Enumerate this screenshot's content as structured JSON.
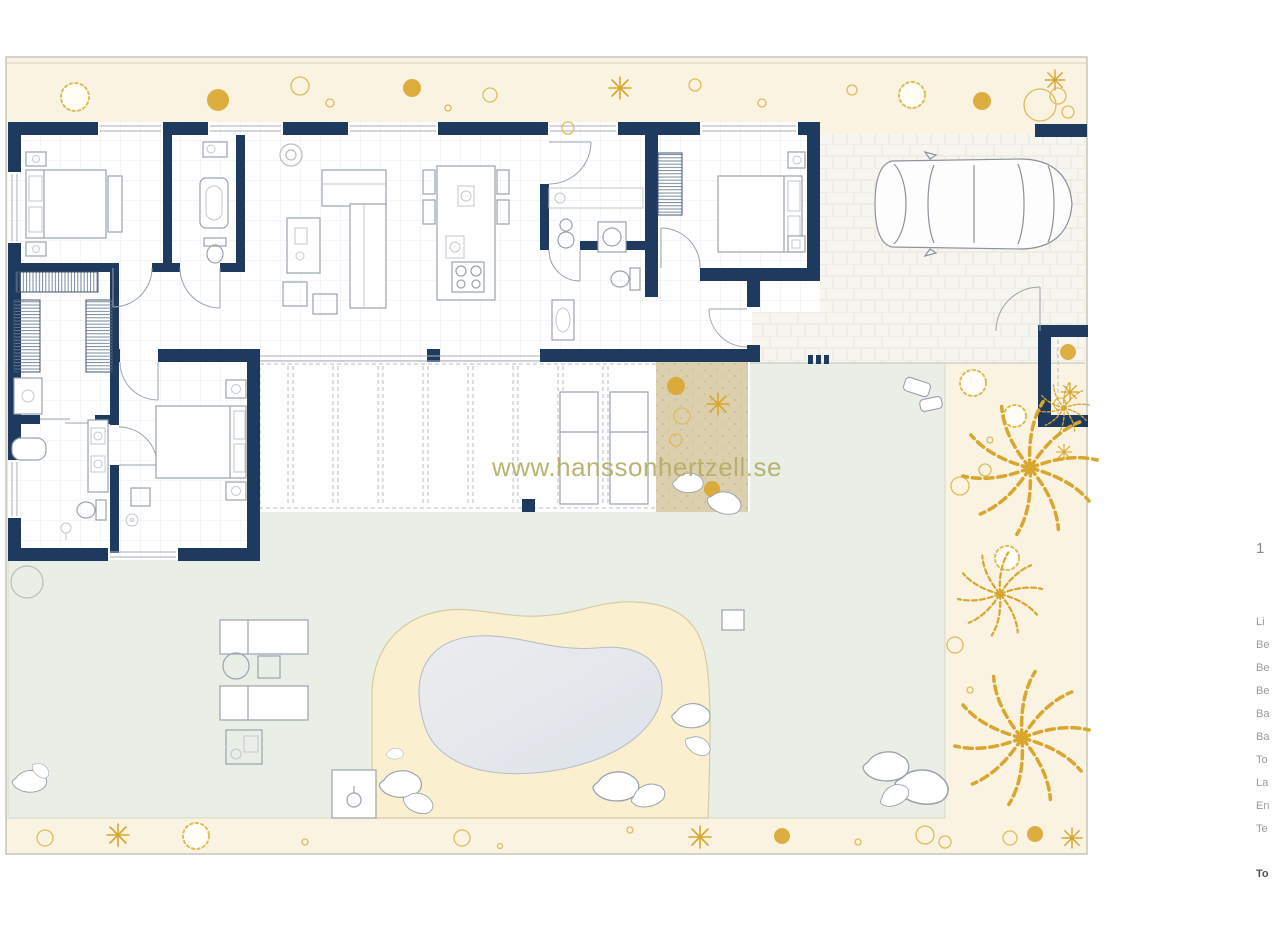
{
  "watermark": {
    "text": "www.hanssonhertzell.se"
  },
  "legend": {
    "top_fragment": "1",
    "items": [
      "Li",
      "Be",
      "Be",
      "Be",
      "Ba",
      "Ba",
      "To",
      "La",
      "En",
      "Te"
    ],
    "total_fragment": "To"
  },
  "colors": {
    "wall": "#1f3a5f",
    "plot-band": "#faf3e2",
    "garden": "#e9efe7",
    "driveway": "#f7f5ef",
    "brick-line": "#e7e3d8",
    "gravel": "#dbcfae",
    "pool-deck": "#faf0cf",
    "pool-water-1": "#ececee",
    "pool-water-2": "#dde3ea",
    "gold": "#d9a62e",
    "gold-light": "#dfbc5a",
    "line": "#9aa3ad",
    "grid": "#e9edf3",
    "boundary": "#b9b7ad",
    "watermark": "#b5ae67",
    "legend-text": "#9a9a9a",
    "legend-strong": "#555555"
  }
}
